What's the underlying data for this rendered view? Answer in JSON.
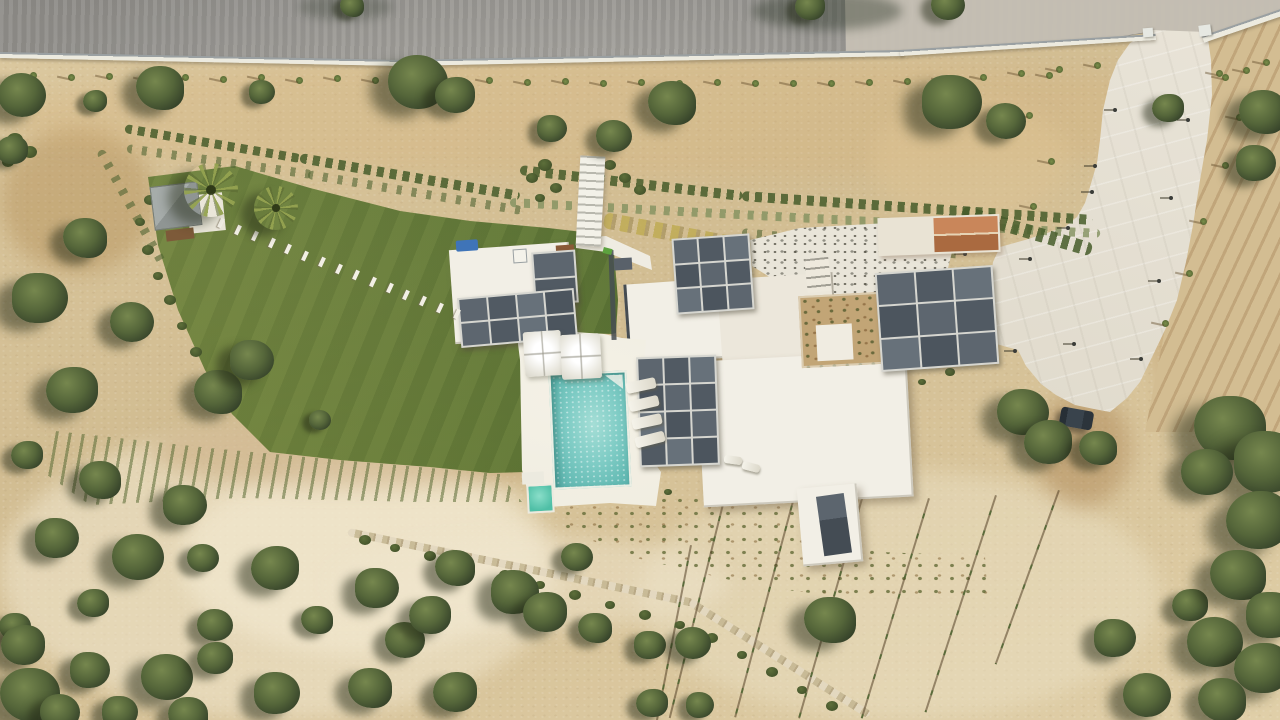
{
  "scene": {
    "type": "aerial-drone-photograph",
    "subject": "Top-down view of a modern white flat-roof villa with dark glass skylight grids, turquoise swimming pool with sun loungers and umbrellas, large lawn with stepping-stone path and palm trees, white concrete driveway with gated entrance off an asphalt road, terraced shrub rows, vineyard rows and surrounding arid olive grove"
  },
  "palette": {
    "sand_base": "#d8c59c",
    "sand_light": "#ecdfbd",
    "sand_dark": "#c2a576",
    "dirt": "#a98a58",
    "road": "#9c9a96",
    "road_light": "#b2b0ab",
    "concrete_pale": "#c7c2b6",
    "wall_white": "#eceadf",
    "wall_gray": "#9aa0a2",
    "lawn": "#5d7936",
    "lawn_dark": "#4a652c",
    "lawn_light": "#7a8c4c",
    "tree_light": "#76874e",
    "tree_mid": "#55663a",
    "tree_dark": "#36432a",
    "roof_white": "#f2efe6",
    "roof_shade": "#e4dfd2",
    "frame": "#d6d6d0",
    "glass_a": "#4c555e",
    "glass_b": "#5d666f",
    "glass_c": "#515a63",
    "glass_d": "#67717a",
    "pool": "#7fccc5",
    "pool_light": "#a9e0d9",
    "pool_dark": "#59b1ad",
    "kiddie": "#5ec9b3",
    "driveway": "#e4dfd3",
    "terracotta_a": "#c9865a",
    "terracotta_b": "#aa6a40",
    "car": "#2f3941",
    "blue_item": "#3f74b8",
    "shed_gray": "#9aa09e",
    "bench_brown": "#7d5a39"
  },
  "features": {
    "glass_grids": [
      {
        "name": "guest-pavilion-skylight-column",
        "x": 533,
        "y": 251,
        "w": 40,
        "h": 49,
        "cols": 1,
        "rows": 2,
        "rot": -4
      },
      {
        "name": "guest-pavilion-skylight-band",
        "x": 459,
        "y": 293,
        "w": 113,
        "h": 46,
        "cols": 4,
        "rows": 2,
        "rot": -5
      },
      {
        "name": "main-house-upper-skylight",
        "x": 674,
        "y": 236,
        "w": 74,
        "h": 72,
        "cols": 3,
        "rows": 3,
        "rot": -4
      },
      {
        "name": "main-house-living-skylight",
        "x": 638,
        "y": 356,
        "w": 76,
        "h": 106,
        "cols": 3,
        "rows": 4,
        "rot": -2
      },
      {
        "name": "east-pavilion-skylight",
        "x": 878,
        "y": 269,
        "w": 114,
        "h": 95,
        "cols": 3,
        "rows": 3,
        "rot": -4
      }
    ],
    "olive_trees": [
      [
        22,
        95,
        24
      ],
      [
        95,
        101,
        12
      ],
      [
        160,
        88,
        24
      ],
      [
        262,
        92,
        13
      ],
      [
        418,
        82,
        30
      ],
      [
        455,
        95,
        20
      ],
      [
        672,
        103,
        24
      ],
      [
        952,
        102,
        30
      ],
      [
        1006,
        121,
        20
      ],
      [
        1168,
        108,
        16
      ],
      [
        1263,
        112,
        24
      ],
      [
        1256,
        163,
        20
      ],
      [
        948,
        5,
        17
      ],
      [
        810,
        6,
        15
      ],
      [
        352,
        6,
        12
      ],
      [
        552,
        128,
        15
      ],
      [
        614,
        136,
        18
      ],
      [
        12,
        150,
        16
      ],
      [
        85,
        238,
        22
      ],
      [
        40,
        298,
        28
      ],
      [
        132,
        322,
        22
      ],
      [
        72,
        390,
        26
      ],
      [
        218,
        392,
        24
      ],
      [
        252,
        360,
        22
      ],
      [
        320,
        420,
        11
      ],
      [
        27,
        455,
        16
      ],
      [
        100,
        480,
        21
      ],
      [
        57,
        538,
        22
      ],
      [
        138,
        557,
        26
      ],
      [
        93,
        603,
        16
      ],
      [
        15,
        627,
        16
      ],
      [
        185,
        505,
        22
      ],
      [
        203,
        558,
        16
      ],
      [
        275,
        568,
        24
      ],
      [
        317,
        620,
        16
      ],
      [
        377,
        588,
        22
      ],
      [
        405,
        640,
        20
      ],
      [
        430,
        615,
        21
      ],
      [
        455,
        568,
        20
      ],
      [
        515,
        592,
        24
      ],
      [
        577,
        557,
        16
      ],
      [
        455,
        692,
        22
      ],
      [
        370,
        688,
        22
      ],
      [
        277,
        693,
        23
      ],
      [
        167,
        677,
        26
      ],
      [
        23,
        645,
        22
      ],
      [
        30,
        695,
        30
      ],
      [
        90,
        670,
        20
      ],
      [
        215,
        625,
        18
      ],
      [
        215,
        658,
        18
      ],
      [
        188,
        715,
        20
      ],
      [
        120,
        712,
        18
      ],
      [
        60,
        712,
        20
      ],
      [
        545,
        612,
        22
      ],
      [
        595,
        628,
        17
      ],
      [
        650,
        645,
        16
      ],
      [
        693,
        643,
        18
      ],
      [
        652,
        703,
        16
      ],
      [
        830,
        620,
        26
      ],
      [
        700,
        705,
        14
      ],
      [
        1023,
        412,
        26
      ],
      [
        1048,
        442,
        24
      ],
      [
        1098,
        448,
        19
      ],
      [
        1115,
        638,
        21
      ],
      [
        1147,
        695,
        24
      ],
      [
        1190,
        605,
        18
      ],
      [
        1230,
        428,
        36
      ],
      [
        1268,
        462,
        34
      ],
      [
        1207,
        472,
        26
      ],
      [
        1258,
        520,
        32
      ],
      [
        1238,
        575,
        28
      ],
      [
        1272,
        615,
        26
      ],
      [
        1215,
        642,
        28
      ],
      [
        1262,
        668,
        28
      ],
      [
        1222,
        700,
        24
      ]
    ],
    "palms": [
      {
        "x": 211,
        "y": 190,
        "r": 27
      },
      {
        "x": 276,
        "y": 208,
        "r": 22
      }
    ],
    "shrub_clumps": [
      [
        365,
        540,
        6
      ],
      [
        395,
        548,
        5
      ],
      [
        430,
        556,
        6
      ],
      [
        470,
        566,
        5
      ],
      [
        505,
        575,
        6
      ],
      [
        540,
        585,
        5
      ],
      [
        575,
        595,
        6
      ],
      [
        610,
        605,
        5
      ],
      [
        645,
        615,
        6
      ],
      [
        680,
        625,
        5
      ],
      [
        712,
        638,
        6
      ],
      [
        742,
        655,
        5
      ],
      [
        772,
        672,
        6
      ],
      [
        802,
        690,
        5
      ],
      [
        832,
        706,
        6
      ],
      [
        545,
        165,
        7
      ],
      [
        532,
        178,
        6
      ],
      [
        556,
        188,
        6
      ],
      [
        540,
        198,
        5
      ],
      [
        610,
        165,
        6
      ],
      [
        625,
        178,
        6
      ],
      [
        640,
        190,
        6
      ],
      [
        150,
        200,
        6
      ],
      [
        140,
        222,
        5
      ],
      [
        148,
        250,
        6
      ],
      [
        158,
        276,
        5
      ],
      [
        170,
        300,
        6
      ],
      [
        182,
        326,
        5
      ],
      [
        196,
        352,
        6
      ],
      [
        210,
        376,
        5
      ],
      [
        15,
        140,
        8
      ],
      [
        30,
        152,
        7
      ],
      [
        8,
        162,
        6
      ],
      [
        900,
        300,
        5
      ],
      [
        915,
        320,
        5
      ],
      [
        932,
        345,
        5
      ],
      [
        950,
        372,
        5
      ],
      [
        922,
        382,
        4
      ],
      [
        902,
        402,
        4
      ],
      [
        958,
        312,
        4
      ],
      [
        938,
        298,
        4
      ],
      [
        655,
        475,
        5
      ],
      [
        668,
        492,
        4
      ]
    ],
    "hedge_rows": [
      {
        "x1": 125,
        "y1": 128,
        "x2": 300,
        "y2": 158,
        "h": 9,
        "type": 0
      },
      {
        "x1": 127,
        "y1": 148,
        "x2": 312,
        "y2": 174,
        "h": 9,
        "type": 1
      },
      {
        "x1": 300,
        "y1": 158,
        "x2": 520,
        "y2": 196,
        "h": 10,
        "type": 0
      },
      {
        "x1": 308,
        "y1": 174,
        "x2": 522,
        "y2": 210,
        "h": 9,
        "type": 1
      },
      {
        "x1": 520,
        "y1": 170,
        "x2": 742,
        "y2": 196,
        "h": 10,
        "type": 0
      },
      {
        "x1": 742,
        "y1": 196,
        "x2": 1092,
        "y2": 220,
        "h": 10,
        "type": 0
      },
      {
        "x1": 510,
        "y1": 202,
        "x2": 1100,
        "y2": 233,
        "h": 9,
        "type": 2
      },
      {
        "x1": 604,
        "y1": 220,
        "x2": 742,
        "y2": 246,
        "h": 16,
        "type": 3
      },
      {
        "x1": 742,
        "y1": 232,
        "x2": 962,
        "y2": 254,
        "h": 9,
        "type": 1
      },
      {
        "x1": 962,
        "y1": 212,
        "x2": 1092,
        "y2": 250,
        "h": 14,
        "type": 0
      },
      {
        "x1": 100,
        "y1": 150,
        "x2": 162,
        "y2": 262,
        "h": 9,
        "type": 1
      }
    ],
    "stepping_stones": {
      "x1": 216,
      "y1": 221,
      "x2": 452,
      "y2": 312,
      "count": 15,
      "angle": 115
    },
    "roadside_saplings": [
      [
        30,
        72
      ],
      [
        68,
        74
      ],
      [
        106,
        73
      ],
      [
        144,
        75
      ],
      [
        182,
        74
      ],
      [
        220,
        76
      ],
      [
        258,
        74
      ],
      [
        296,
        77
      ],
      [
        334,
        75
      ],
      [
        372,
        77
      ],
      [
        410,
        76
      ],
      [
        448,
        78
      ],
      [
        486,
        77
      ],
      [
        524,
        79
      ],
      [
        562,
        78
      ],
      [
        600,
        80
      ],
      [
        638,
        79
      ],
      [
        676,
        80
      ],
      [
        714,
        79
      ],
      [
        752,
        80
      ],
      [
        790,
        80
      ],
      [
        828,
        80
      ],
      [
        866,
        79
      ],
      [
        904,
        78
      ],
      [
        942,
        76
      ],
      [
        980,
        74
      ],
      [
        1018,
        70
      ],
      [
        1056,
        66
      ],
      [
        1094,
        62
      ],
      [
        1222,
        74
      ],
      [
        1243,
        67
      ],
      [
        1263,
        59
      ]
    ],
    "driveway_saplings": [
      [
        1046,
        72
      ],
      [
        1026,
        112
      ],
      [
        1048,
        158
      ],
      [
        1030,
        203
      ],
      [
        1216,
        70
      ],
      [
        1236,
        114
      ],
      [
        1222,
        162
      ],
      [
        1200,
        218
      ],
      [
        1186,
        270
      ],
      [
        1162,
        320
      ]
    ],
    "driveway_lights": [
      [
        1113,
        108
      ],
      [
        1090,
        190
      ],
      [
        1066,
        226
      ],
      [
        1028,
        257
      ],
      [
        963,
        252
      ],
      [
        1013,
        349
      ],
      [
        1072,
        342
      ],
      [
        1139,
        357
      ],
      [
        1093,
        164
      ],
      [
        1169,
        196
      ],
      [
        1157,
        279
      ],
      [
        1186,
        118
      ]
    ],
    "irrigation_lines": [
      {
        "x": 728,
        "y": 480,
        "len": 245,
        "rot": 14
      },
      {
        "x": 795,
        "y": 490,
        "len": 235,
        "rot": 15
      },
      {
        "x": 862,
        "y": 495,
        "len": 232,
        "rot": 16
      },
      {
        "x": 928,
        "y": 498,
        "len": 230,
        "rot": 17
      },
      {
        "x": 995,
        "y": 495,
        "len": 228,
        "rot": 18
      },
      {
        "x": 1058,
        "y": 490,
        "len": 185,
        "rot": 20
      },
      {
        "x": 690,
        "y": 545,
        "len": 180,
        "rot": 11
      }
    ],
    "pool_loungers": [
      {
        "x": 626,
        "y": 380,
        "w": 30,
        "h": 11,
        "rot": -12
      },
      {
        "x": 629,
        "y": 398,
        "w": 30,
        "h": 11,
        "rot": -13
      },
      {
        "x": 632,
        "y": 416,
        "w": 30,
        "h": 11,
        "rot": -12
      },
      {
        "x": 635,
        "y": 434,
        "w": 30,
        "h": 11,
        "rot": -14
      },
      {
        "x": 724,
        "y": 456,
        "w": 18,
        "h": 8,
        "rot": 8
      },
      {
        "x": 742,
        "y": 463,
        "w": 18,
        "h": 8,
        "rot": 14
      }
    ],
    "sand_patches": [
      {
        "x": 0,
        "y": 425,
        "w": 560,
        "h": 295,
        "c": "rgba(242,233,209,0.55)"
      },
      {
        "x": 180,
        "y": 465,
        "w": 360,
        "h": 190,
        "c": "rgba(247,240,218,0.5)"
      },
      {
        "x": 0,
        "y": 128,
        "w": 155,
        "h": 145,
        "c": "rgba(164,120,62,0.33)"
      },
      {
        "x": 150,
        "y": 418,
        "w": 420,
        "h": 70,
        "c": "rgba(176,134,80,0.3)"
      },
      {
        "x": 0,
        "y": 58,
        "w": 1280,
        "h": 118,
        "c": "rgba(214,174,112,0.22)"
      },
      {
        "x": 1145,
        "y": 120,
        "w": 135,
        "h": 310,
        "c": "rgba(174,132,78,0.3)"
      },
      {
        "x": 640,
        "y": 470,
        "w": 520,
        "h": 250,
        "c": "rgba(238,228,202,0.45)"
      },
      {
        "x": 1035,
        "y": 392,
        "w": 95,
        "h": 115,
        "c": "rgba(155,108,58,0.35)"
      },
      {
        "x": 330,
        "y": 535,
        "w": 400,
        "h": 95,
        "c": "rgba(240,230,206,0.5)"
      },
      {
        "x": 870,
        "y": 100,
        "w": 200,
        "h": 120,
        "c": "rgba(221,196,147,0.5)"
      },
      {
        "x": 260,
        "y": 250,
        "w": 180,
        "h": 160,
        "c": "rgba(229,209,166,0.4)"
      }
    ]
  }
}
